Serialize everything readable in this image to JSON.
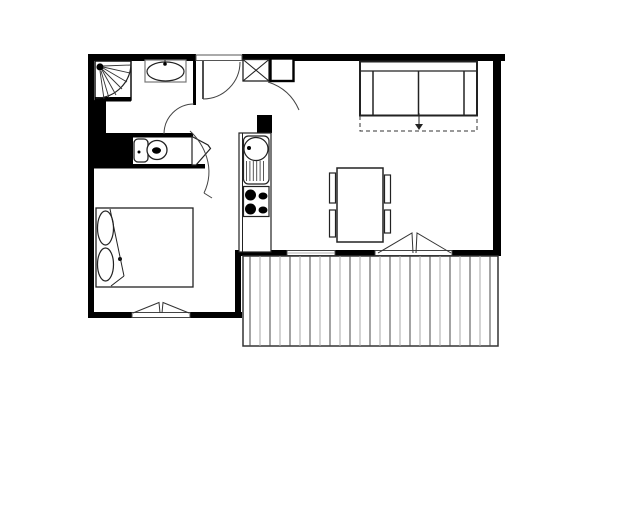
{
  "page": {
    "background": "#ffffff"
  },
  "canvas": {
    "width": 640,
    "height": 524
  },
  "colors": {
    "wall": "#000000",
    "line": "#222222",
    "thin_line": "#555555",
    "deck_dark": "#4a4a4a",
    "deck_light": "#aaaaaa",
    "paper": "#ffffff"
  },
  "chart_data": {
    "type": "floor-plan-diagram",
    "title": "",
    "primitives": [
      {
        "t": "rect",
        "n": "wall-top-left",
        "x": 88,
        "y": 54,
        "w": 108,
        "h": 7,
        "f": "#000"
      },
      {
        "t": "rect",
        "n": "wall-top-right",
        "x": 242,
        "y": 54,
        "w": 263,
        "h": 7,
        "f": "#000"
      },
      {
        "t": "rect",
        "n": "wall-right",
        "x": 493,
        "y": 54,
        "w": 8,
        "h": 202,
        "f": "#000"
      },
      {
        "t": "rect",
        "n": "wall-left",
        "x": 88,
        "y": 54,
        "w": 6,
        "h": 264,
        "f": "#000"
      },
      {
        "t": "rect",
        "n": "wall-bedroom-bottom-left",
        "x": 88,
        "y": 312,
        "w": 44,
        "h": 6,
        "f": "#000"
      },
      {
        "t": "rect",
        "n": "wall-bedroom-bottom-right",
        "x": 190,
        "y": 312,
        "w": 52,
        "h": 6,
        "f": "#000"
      },
      {
        "t": "rect",
        "n": "wall-bedroom-right",
        "x": 235,
        "y": 250,
        "w": 6,
        "h": 68,
        "f": "#000"
      },
      {
        "t": "rect",
        "n": "wall-balcony-1",
        "x": 238,
        "y": 250,
        "w": 49,
        "h": 6,
        "f": "#000"
      },
      {
        "t": "rect",
        "n": "wall-balcony-2",
        "x": 335,
        "y": 250,
        "w": 40,
        "h": 6,
        "f": "#000"
      },
      {
        "t": "rect",
        "n": "wall-balcony-3",
        "x": 452,
        "y": 250,
        "w": 46,
        "h": 6,
        "f": "#000"
      },
      {
        "t": "rect",
        "n": "wall-mass-below-shower",
        "x": 93,
        "y": 100,
        "w": 13,
        "h": 36,
        "f": "#000"
      },
      {
        "t": "rect",
        "n": "wall-mass-wc",
        "x": 93,
        "y": 133,
        "w": 40,
        "h": 33,
        "f": "#000"
      },
      {
        "t": "rect",
        "n": "wall-wc-niche-top",
        "x": 130,
        "y": 133,
        "w": 63,
        "h": 4.5,
        "f": "#000"
      },
      {
        "t": "rect",
        "n": "wall-bedroom-top",
        "x": 88,
        "y": 164,
        "w": 117,
        "h": 4.5,
        "f": "#000"
      },
      {
        "t": "rect",
        "n": "wall-bathroom-right",
        "x": 193,
        "y": 54,
        "w": 3,
        "h": 51,
        "f": "#000"
      },
      {
        "t": "rect",
        "n": "wall-kitchen-stub",
        "x": 257,
        "y": 115,
        "w": 15,
        "h": 18,
        "f": "#000"
      },
      {
        "t": "rect",
        "n": "entry-door-opening",
        "x": 196,
        "y": 55,
        "w": 46,
        "h": 5.5,
        "f": "#fff",
        "s": "#555",
        "sw": 1
      },
      {
        "t": "line",
        "n": "entry-door-leaf",
        "x1": 203,
        "y1": 61,
        "x2": 203,
        "y2": 99,
        "s": "#222",
        "sw": 1.6
      },
      {
        "t": "path",
        "n": "entry-door-swing-arc",
        "d": "M 240 62 A 37 37 0 0 1 203 99",
        "s": "#444",
        "sw": 1
      },
      {
        "t": "rect",
        "n": "shower-tray",
        "x": 95,
        "y": 61,
        "w": 36,
        "h": 39,
        "f": "#fff",
        "s": "#111",
        "sw": 1.5
      },
      {
        "t": "rect",
        "n": "shower-tray-edge",
        "x": 95,
        "y": 97,
        "w": 36,
        "h": 4.5,
        "f": "#000"
      },
      {
        "t": "path",
        "n": "shower-tray-arc",
        "d": "M 131 63 A 35 35 0 0 1 96 98",
        "s": "#222",
        "sw": 1.2
      },
      {
        "t": "circle",
        "n": "shower-head-dot",
        "cx": 100,
        "cy": 67,
        "r": 3.6,
        "f": "#000"
      },
      {
        "t": "line",
        "n": "shower-spray-1",
        "x1": 103,
        "y1": 66,
        "x2": 131,
        "y2": 65,
        "s": "#333",
        "sw": 0.9
      },
      {
        "t": "line",
        "n": "shower-spray-2",
        "x1": 103,
        "y1": 67,
        "x2": 130,
        "y2": 73,
        "s": "#333",
        "sw": 0.9
      },
      {
        "t": "line",
        "n": "shower-spray-3",
        "x1": 103,
        "y1": 68,
        "x2": 127,
        "y2": 82,
        "s": "#333",
        "sw": 0.9
      },
      {
        "t": "line",
        "n": "shower-spray-4",
        "x1": 102,
        "y1": 69,
        "x2": 122,
        "y2": 89,
        "s": "#333",
        "sw": 0.9
      },
      {
        "t": "line",
        "n": "shower-spray-5",
        "x1": 102,
        "y1": 70,
        "x2": 116,
        "y2": 95,
        "s": "#333",
        "sw": 0.9
      },
      {
        "t": "line",
        "n": "shower-spray-6",
        "x1": 101,
        "y1": 71,
        "x2": 109,
        "y2": 98,
        "s": "#333",
        "sw": 0.9
      },
      {
        "t": "line",
        "n": "shower-spray-7",
        "x1": 100,
        "y1": 71,
        "x2": 104,
        "y2": 99,
        "s": "#333",
        "sw": 0.9
      },
      {
        "t": "rect",
        "n": "bath-sink-counter",
        "x": 145,
        "y": 60,
        "w": 41,
        "h": 22,
        "f": "#fff",
        "s": "#777",
        "sw": 1.2
      },
      {
        "t": "ellipse",
        "n": "bath-sink-basin",
        "cx": 165.5,
        "cy": 71.5,
        "rx": 18.5,
        "ry": 9.5,
        "s": "#222",
        "sw": 1.2
      },
      {
        "t": "line",
        "n": "bath-sink-tap-tick",
        "x1": 165,
        "y1": 60,
        "x2": 165,
        "y2": 63,
        "s": "#222",
        "sw": 1
      },
      {
        "t": "circle",
        "n": "bath-sink-tap-dot",
        "cx": 165,
        "cy": 64,
        "r": 1.8,
        "f": "#000"
      },
      {
        "t": "path",
        "n": "bathroom-door-swing-arc",
        "d": "M 194 104 A 30 30 0 0 0 164 134",
        "s": "#444",
        "sw": 1
      },
      {
        "t": "rect",
        "n": "toilet-cistern",
        "x": 134,
        "y": 139,
        "w": 14,
        "h": 23,
        "rx": 4,
        "f": "#fff",
        "s": "#222",
        "sw": 1.3
      },
      {
        "t": "circle",
        "n": "toilet-cistern-dot",
        "cx": 139,
        "cy": 152,
        "r": 1.5,
        "f": "#000"
      },
      {
        "t": "ellipse",
        "n": "toilet-bowl",
        "cx": 157,
        "cy": 150,
        "rx": 10,
        "ry": 9.5,
        "s": "#222",
        "sw": 1.3,
        "f": "#fff"
      },
      {
        "t": "ellipse",
        "n": "toilet-bowl-hole",
        "cx": 156.5,
        "cy": 150.5,
        "rx": 4.5,
        "ry": 3.2,
        "f": "#000"
      },
      {
        "t": "polygon",
        "n": "wc-door-leaf",
        "p": "192,136.5 208,145 210.5,148.5 196,165 192,165",
        "f": "#fff",
        "s": "#222",
        "sw": 1.2
      },
      {
        "t": "path",
        "n": "hall-door-swing-arc",
        "d": "M 190 131 C 204 144 216 168 204 193",
        "s": "#444",
        "sw": 1
      },
      {
        "t": "line",
        "n": "hall-door-arc-tick",
        "x1": 204,
        "y1": 193,
        "x2": 212,
        "y2": 198,
        "s": "#444",
        "sw": 1
      },
      {
        "t": "rect",
        "n": "entry-closet-box",
        "x": 243,
        "y": 59.5,
        "w": 26,
        "h": 21.5,
        "f": "#fff",
        "s": "#222",
        "sw": 1.3
      },
      {
        "t": "line",
        "n": "entry-closet-x1",
        "x1": 243,
        "y1": 59.5,
        "x2": 269,
        "y2": 81,
        "s": "#222",
        "sw": 1.1
      },
      {
        "t": "line",
        "n": "entry-closet-x2",
        "x1": 269,
        "y1": 59.5,
        "x2": 243,
        "y2": 81,
        "s": "#222",
        "sw": 1.1
      },
      {
        "t": "rect",
        "n": "entry-duct-box",
        "x": 270.5,
        "y": 58.5,
        "w": 23,
        "h": 22.5,
        "f": "#fff",
        "s": "#000",
        "sw": 2.4
      },
      {
        "t": "path",
        "n": "closet-door-swing-arc",
        "d": "M 268 82 Q 290 89 299 110",
        "s": "#444",
        "sw": 1
      },
      {
        "t": "rect",
        "n": "kitchen-unit-outline",
        "x": 239,
        "y": 133,
        "w": 32,
        "h": 119,
        "f": "#fff",
        "s": "#222",
        "sw": 1.2
      },
      {
        "t": "line",
        "n": "kitchen-unit-inner-edge",
        "x1": 242.5,
        "y1": 133,
        "x2": 242.5,
        "y2": 252,
        "s": "#222",
        "sw": 1
      },
      {
        "t": "rect",
        "n": "kitchen-sink-module",
        "x": 243.5,
        "y": 136,
        "w": 25.5,
        "h": 48,
        "rx": 5,
        "f": "#fff",
        "s": "#222",
        "sw": 1.2
      },
      {
        "t": "ellipse",
        "n": "kitchen-sink-basin",
        "cx": 256,
        "cy": 149,
        "rx": 12,
        "ry": 11.5,
        "s": "#222",
        "sw": 1.2
      },
      {
        "t": "circle",
        "n": "kitchen-sink-tap-dot",
        "cx": 249,
        "cy": 148,
        "r": 2,
        "f": "#000"
      },
      {
        "t": "vlines",
        "n": "kitchen-drainboard-line",
        "x1": 246.5,
        "x2": 266.5,
        "step": 3.4,
        "y1": 161,
        "y2": 181,
        "s": [
          "#444"
        ],
        "sw": 0.9
      },
      {
        "t": "rect",
        "n": "kitchen-stove-module",
        "x": 243.5,
        "y": 186.5,
        "w": 25.5,
        "h": 30,
        "f": "#fff",
        "s": "#222",
        "sw": 1.2
      },
      {
        "t": "circle",
        "n": "stove-burner-1",
        "cx": 250.5,
        "cy": 195,
        "r": 5.5,
        "f": "#000"
      },
      {
        "t": "circle",
        "n": "stove-burner-2",
        "cx": 250.5,
        "cy": 209,
        "r": 5.5,
        "f": "#000"
      },
      {
        "t": "ellipse",
        "n": "stove-burner-3",
        "cx": 263,
        "cy": 196,
        "rx": 4.5,
        "ry": 3.5,
        "f": "#000"
      },
      {
        "t": "ellipse",
        "n": "stove-burner-4",
        "cx": 263,
        "cy": 210,
        "rx": 4.5,
        "ry": 3.5,
        "f": "#000"
      },
      {
        "t": "rect",
        "n": "sofa-outline",
        "x": 360,
        "y": 61.5,
        "w": 117,
        "h": 54,
        "f": "#fff",
        "s": "#222",
        "sw": 2
      },
      {
        "t": "line",
        "n": "sofa-back-line",
        "x1": 360,
        "y1": 71,
        "x2": 477,
        "y2": 71,
        "s": "#222",
        "sw": 1.2
      },
      {
        "t": "line",
        "n": "sofa-armrest-left",
        "x1": 373,
        "y1": 71,
        "x2": 373,
        "y2": 115.5,
        "s": "#222",
        "sw": 1.5
      },
      {
        "t": "line",
        "n": "sofa-armrest-right",
        "x1": 464,
        "y1": 71,
        "x2": 464,
        "y2": 115.5,
        "s": "#222",
        "sw": 1.5
      },
      {
        "t": "line",
        "n": "sofa-seat-divider",
        "x1": 418.5,
        "y1": 71,
        "x2": 418.5,
        "y2": 115.5,
        "s": "#222",
        "sw": 1.5
      },
      {
        "t": "path",
        "n": "sofabed-extension-dashed",
        "d": "M 360 116 L 360 131 L 477 131 L 477 116",
        "s": "#333",
        "sw": 1,
        "dash": "4,3"
      },
      {
        "t": "line",
        "n": "sofabed-arrow-line",
        "x1": 419,
        "y1": 113,
        "x2": 419,
        "y2": 127,
        "s": "#222",
        "sw": 1
      },
      {
        "t": "polygon",
        "n": "sofabed-arrow-head",
        "p": "415,124 423,124 419,130",
        "f": "#222"
      },
      {
        "t": "rect",
        "n": "dining-table",
        "x": 337,
        "y": 168,
        "w": 46,
        "h": 74,
        "f": "#fff",
        "s": "#222",
        "sw": 1.5
      },
      {
        "t": "rect",
        "n": "dining-chair-1",
        "x": 329.5,
        "y": 173,
        "w": 6,
        "h": 30,
        "f": "#fff",
        "s": "#222",
        "sw": 1.2
      },
      {
        "t": "rect",
        "n": "dining-chair-2",
        "x": 329.5,
        "y": 210,
        "w": 6,
        "h": 27,
        "f": "#fff",
        "s": "#222",
        "sw": 1.2
      },
      {
        "t": "rect",
        "n": "dining-chair-3",
        "x": 384.5,
        "y": 175,
        "w": 6,
        "h": 28,
        "f": "#fff",
        "s": "#222",
        "sw": 1.2
      },
      {
        "t": "rect",
        "n": "dining-chair-4",
        "x": 384.5,
        "y": 210,
        "w": 6,
        "h": 23,
        "f": "#fff",
        "s": "#222",
        "sw": 1.2
      },
      {
        "t": "rect",
        "n": "bed-outline",
        "x": 96,
        "y": 208,
        "w": 97,
        "h": 79,
        "f": "#fff",
        "s": "#222",
        "sw": 1.3
      },
      {
        "t": "ellipse",
        "n": "bed-pillow-1",
        "cx": 105.5,
        "cy": 228,
        "rx": 8,
        "ry": 17,
        "s": "#222",
        "sw": 1.2
      },
      {
        "t": "ellipse",
        "n": "bed-pillow-2",
        "cx": 105.5,
        "cy": 264.5,
        "rx": 8,
        "ry": 16.5,
        "s": "#222",
        "sw": 1.2
      },
      {
        "t": "line",
        "n": "bed-fold-line-1",
        "x1": 110,
        "y1": 209,
        "x2": 124,
        "y2": 276,
        "s": "#222",
        "sw": 1
      },
      {
        "t": "line",
        "n": "bed-fold-line-2",
        "x1": 124,
        "y1": 276,
        "x2": 111,
        "y2": 286,
        "s": "#222",
        "sw": 1
      },
      {
        "t": "circle",
        "n": "bed-fold-dot",
        "cx": 120,
        "cy": 259,
        "r": 2,
        "f": "#111"
      },
      {
        "t": "rect",
        "n": "bedroom-window-opening",
        "x": 132,
        "y": 312.5,
        "w": 58,
        "h": 5,
        "f": "#fff",
        "s": "#444",
        "sw": 1
      },
      {
        "t": "polyline",
        "n": "bedroom-window-casement-left",
        "p": "133,313 159,302.5 160,313",
        "s": "#333",
        "sw": 1
      },
      {
        "t": "polyline",
        "n": "bedroom-window-casement-right",
        "p": "189,313 163,302.5 162,313",
        "s": "#333",
        "sw": 1
      },
      {
        "t": "rect",
        "n": "living-window-opening",
        "x": 287,
        "y": 250.5,
        "w": 48,
        "h": 5,
        "f": "#fff",
        "s": "#444",
        "sw": 1
      },
      {
        "t": "line",
        "n": "living-window-glazing",
        "x1": 287,
        "y1": 253,
        "x2": 335,
        "y2": 253,
        "s": "#999",
        "sw": 0.8
      },
      {
        "t": "rect",
        "n": "balcony-door-opening",
        "x": 375,
        "y": 250.5,
        "w": 77,
        "h": 5,
        "f": "#fff",
        "s": "#444",
        "sw": 1
      },
      {
        "t": "polyline",
        "n": "balcony-door-casement-left",
        "p": "378,253 412,233 413,253",
        "s": "#333",
        "sw": 1
      },
      {
        "t": "polyline",
        "n": "balcony-door-casement-right",
        "p": "451,253 417,233 416,253",
        "s": "#333",
        "sw": 1
      },
      {
        "t": "rect",
        "n": "balcony-outline",
        "x": 243,
        "y": 256,
        "w": 255,
        "h": 90,
        "f": "#fff",
        "s": "#333",
        "sw": 1.5
      },
      {
        "t": "vlines",
        "n": "balcony-deck-stripe",
        "x1": 250,
        "x2": 492,
        "step": 10,
        "y1": 256,
        "y2": 346,
        "s": [
          "#4a4a4a",
          "#aaaaaa"
        ],
        "sw": 1
      }
    ]
  }
}
